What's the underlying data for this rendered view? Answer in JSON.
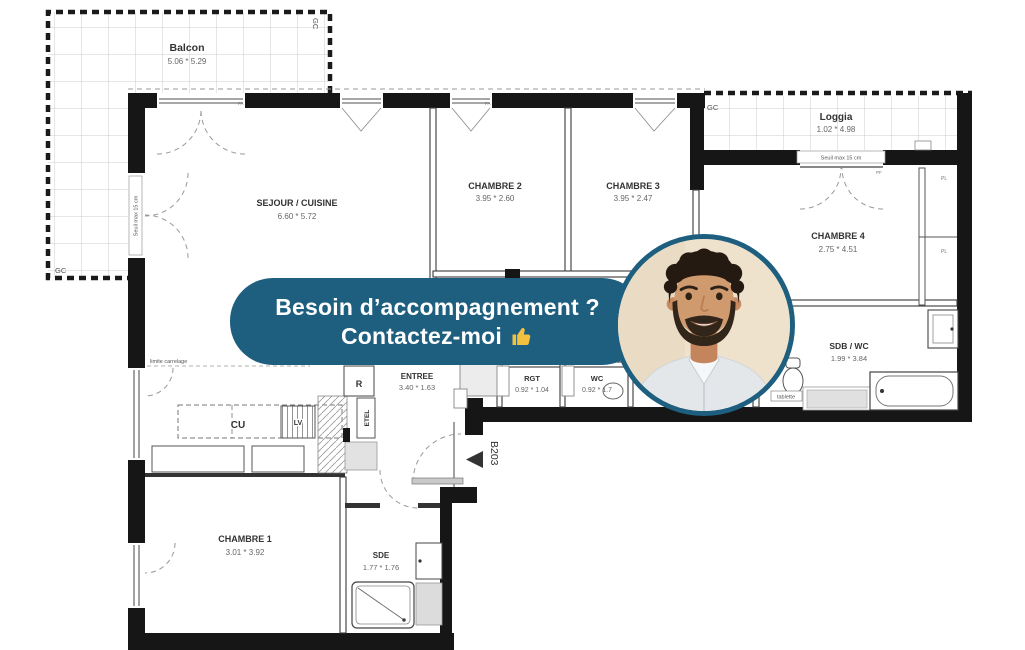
{
  "colors": {
    "accent": "#1e5f80",
    "wall": "#161616",
    "thumb_yellow": "#f4c13f"
  },
  "banner": {
    "line1": "Besoin d’accompagnement ?",
    "line2": "Contactez-moi",
    "thumbs_up_icon": "thumbs-up"
  },
  "plan": {
    "balcon": {
      "name": "Balcon",
      "dims": "5.06 * 5.29"
    },
    "sejour": {
      "name": "SEJOUR / CUISINE",
      "dims": "6.60 * 5.72"
    },
    "chambre2": {
      "name": "CHAMBRE 2",
      "dims": "3.95 * 2.60"
    },
    "chambre3": {
      "name": "CHAMBRE 3",
      "dims": "3.95 * 2.47"
    },
    "loggia": {
      "name": "Loggia",
      "dims": "1.02 * 4.98"
    },
    "chambre4": {
      "name": "CHAMBRE 4",
      "dims": "2.75 * 4.51"
    },
    "sdb": {
      "name": "SDB / WC",
      "dims": "1.99 * 3.84"
    },
    "entree": {
      "name": "ENTREE",
      "dims": "3.40 * 1.63"
    },
    "rgt": {
      "name": "RGT",
      "dims": "0.92 * 1.04"
    },
    "wc": {
      "name": "WC",
      "dims": "0.92 * 1.7"
    },
    "chambre1": {
      "name": "CHAMBRE 1",
      "dims": "3.01 * 3.92"
    },
    "sde": {
      "name": "SDE",
      "dims": "1.77 * 1.76"
    },
    "annotations": {
      "unit": "B203",
      "gc": "GC",
      "seuil": "Seuil max 15 cm",
      "limite": "limite carrelage",
      "tablette": "tablette",
      "cu": "CU",
      "lv": "LV",
      "r": "R",
      "etel": "ETEL",
      "pl": "PL",
      "fa": "FA",
      "pf": "PF"
    }
  }
}
